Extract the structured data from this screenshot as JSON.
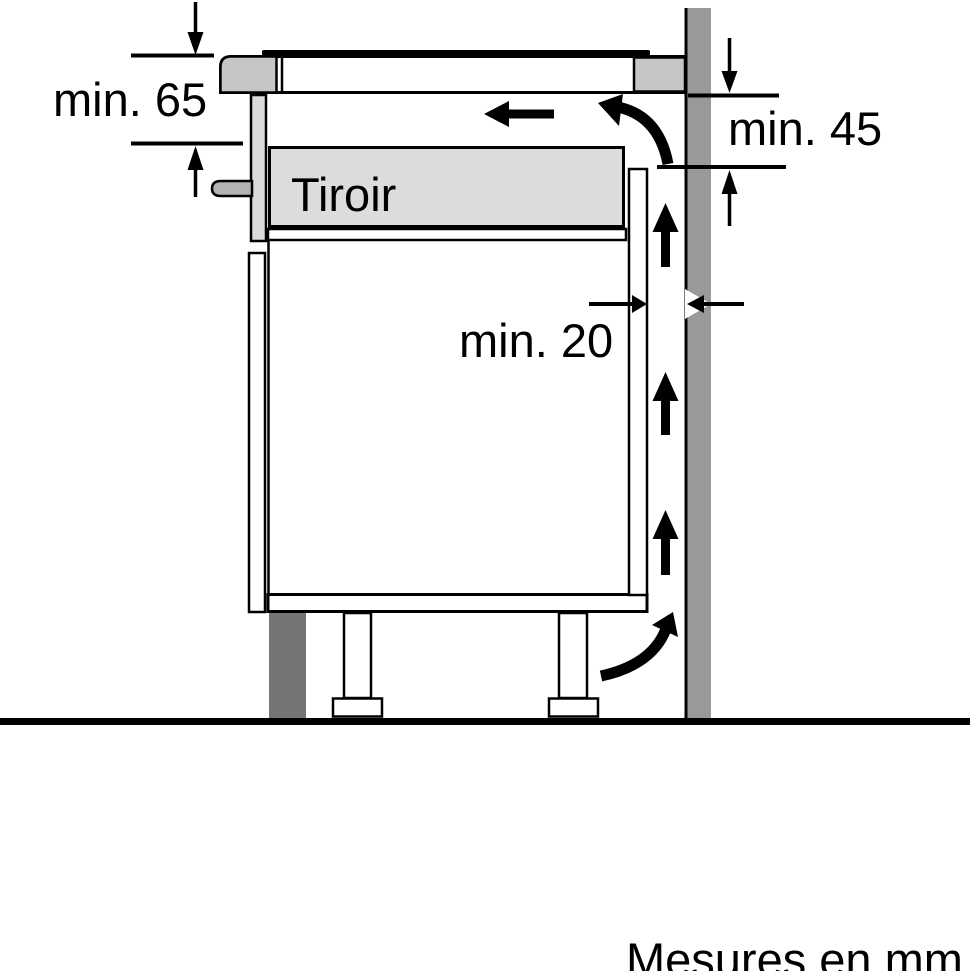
{
  "labels": {
    "min65": "min. 65",
    "min45": "min. 45",
    "min20": "min. 20",
    "drawer": "Tiroir",
    "units": "Mesures en mm"
  },
  "colors": {
    "wall": "#999999",
    "hob_trim": "#c6c6c6",
    "drawer_fill": "#dcdcdc",
    "front_rail": "#dadada",
    "handle": "#b3b3b3",
    "plinth": "#757575",
    "line": "#000000",
    "background": "#ffffff"
  }
}
